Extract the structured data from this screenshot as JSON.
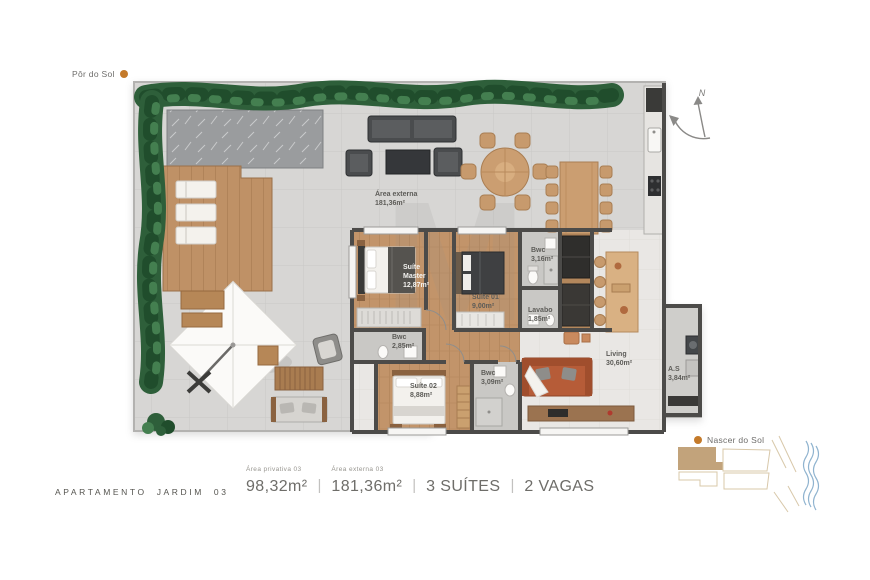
{
  "orientation": {
    "sunset_label": "Pôr do Sol",
    "sunrise_label": "Nascer do Sol",
    "north_label": "N"
  },
  "plan": {
    "watermark": "M",
    "rooms": [
      {
        "id": "area-externa",
        "name": "Área externa",
        "area": "181,36m²"
      },
      {
        "id": "suite-master",
        "name": "Suíte Master",
        "area": "12,87m²"
      },
      {
        "id": "suite-01",
        "name": "Suíte 01",
        "area": "9,00m²"
      },
      {
        "id": "bwc-suite-01",
        "name": "Bwc",
        "area": "3,16m²"
      },
      {
        "id": "lavabo",
        "name": "Lavabo",
        "area": "1,85m²"
      },
      {
        "id": "bwc-master",
        "name": "Bwc",
        "area": "2,85m²"
      },
      {
        "id": "suite-02",
        "name": "Suíte 02",
        "area": "8,88m²"
      },
      {
        "id": "bwc-suite-02",
        "name": "Bwc",
        "area": "3,09m²"
      },
      {
        "id": "living",
        "name": "Living",
        "area": "30,60m²"
      },
      {
        "id": "servico",
        "name": "A.S",
        "area": "3,84m²"
      }
    ]
  },
  "footer": {
    "title": "APARTAMENTO JARDIM 03",
    "divider": "|",
    "specs": [
      {
        "label": "Área privativa 03",
        "value": "98,32m²"
      },
      {
        "label": "Área externa 03",
        "value": "181,36m²"
      },
      {
        "label": "",
        "value": "3 SUÍTES"
      },
      {
        "label": "",
        "value": "2 VAGAS"
      }
    ]
  },
  "colors": {
    "sun_dot": "#c47a2a",
    "hedge_green": "#2e5f3a",
    "terrace_floor": "#d7d6d4",
    "suite_wood": "#c2946a",
    "deck_wood": "#bf9166",
    "wall": "#4c4b49",
    "sofa_terracotta": "#b65c38",
    "keyplan_highlight": "#c2a37b",
    "keyplan_water": "#8fb3cf"
  }
}
